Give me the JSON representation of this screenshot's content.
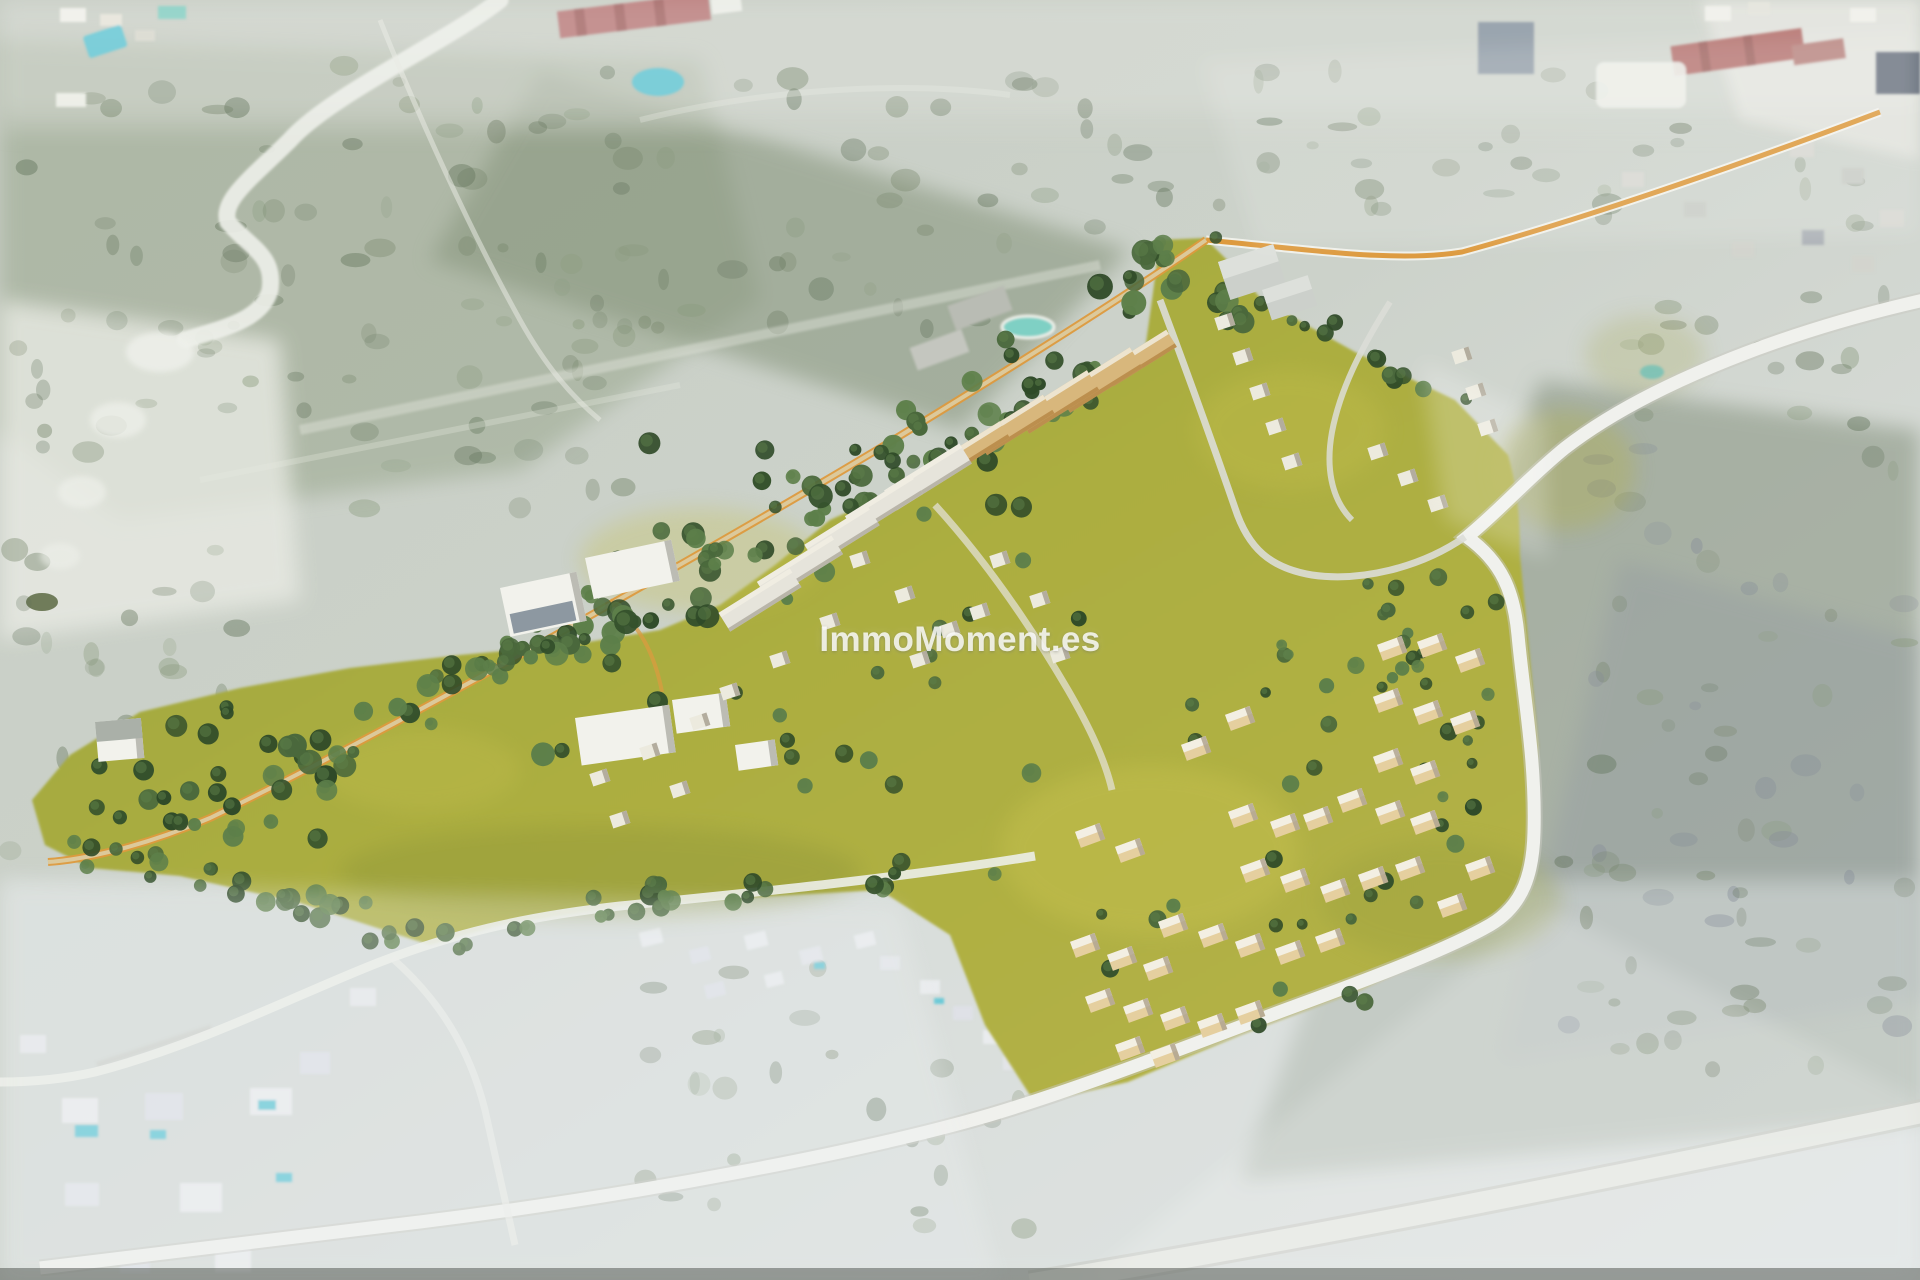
{
  "watermark": {
    "text": "ImmoMoment.es"
  },
  "palette": {
    "aerial_light": "#d6dad2",
    "aerial_mid": "#c2c9bf",
    "aerial_blue": "#dfe4e6",
    "scrub_dark": "#6b7a63",
    "scrub": "#76856a",
    "scrub_light": "#8a9a7e",
    "hill_sage": "#95a090",
    "hill_slate": "#848b99",
    "track_white": "#edefe9",
    "road_white": "#f0f1ed",
    "road_casing": "#c9cac2",
    "road_orange": "#dd9a3e",
    "path_beige": "#dcc99b",
    "grass": "#a9ab3f",
    "grass_light": "#c6c150",
    "grass_dark": "#8a9238",
    "tree_dark": "#35512c",
    "tree": "#4a683c",
    "tree_light": "#5d7f4a",
    "tree_deep": "#2f4a28",
    "villa_tan": "#e5cf9f",
    "villa_side": "#b0a590",
    "building_white": "#f2f2ec",
    "building_side": "#bcbcb4",
    "row_tan": "#d8b77c",
    "row_gray": "#e6e4db",
    "glass_dark": "#7b8894",
    "pool_teal": "#5fc8d6",
    "pool_green": "#7fd0c4",
    "roof_red": "#b06b66",
    "roof_pink": "#bd8382",
    "roof_slate": "#5f6874",
    "suburb_roof": "#d8d8d2",
    "pond_dark": "#5c6a43"
  }
}
